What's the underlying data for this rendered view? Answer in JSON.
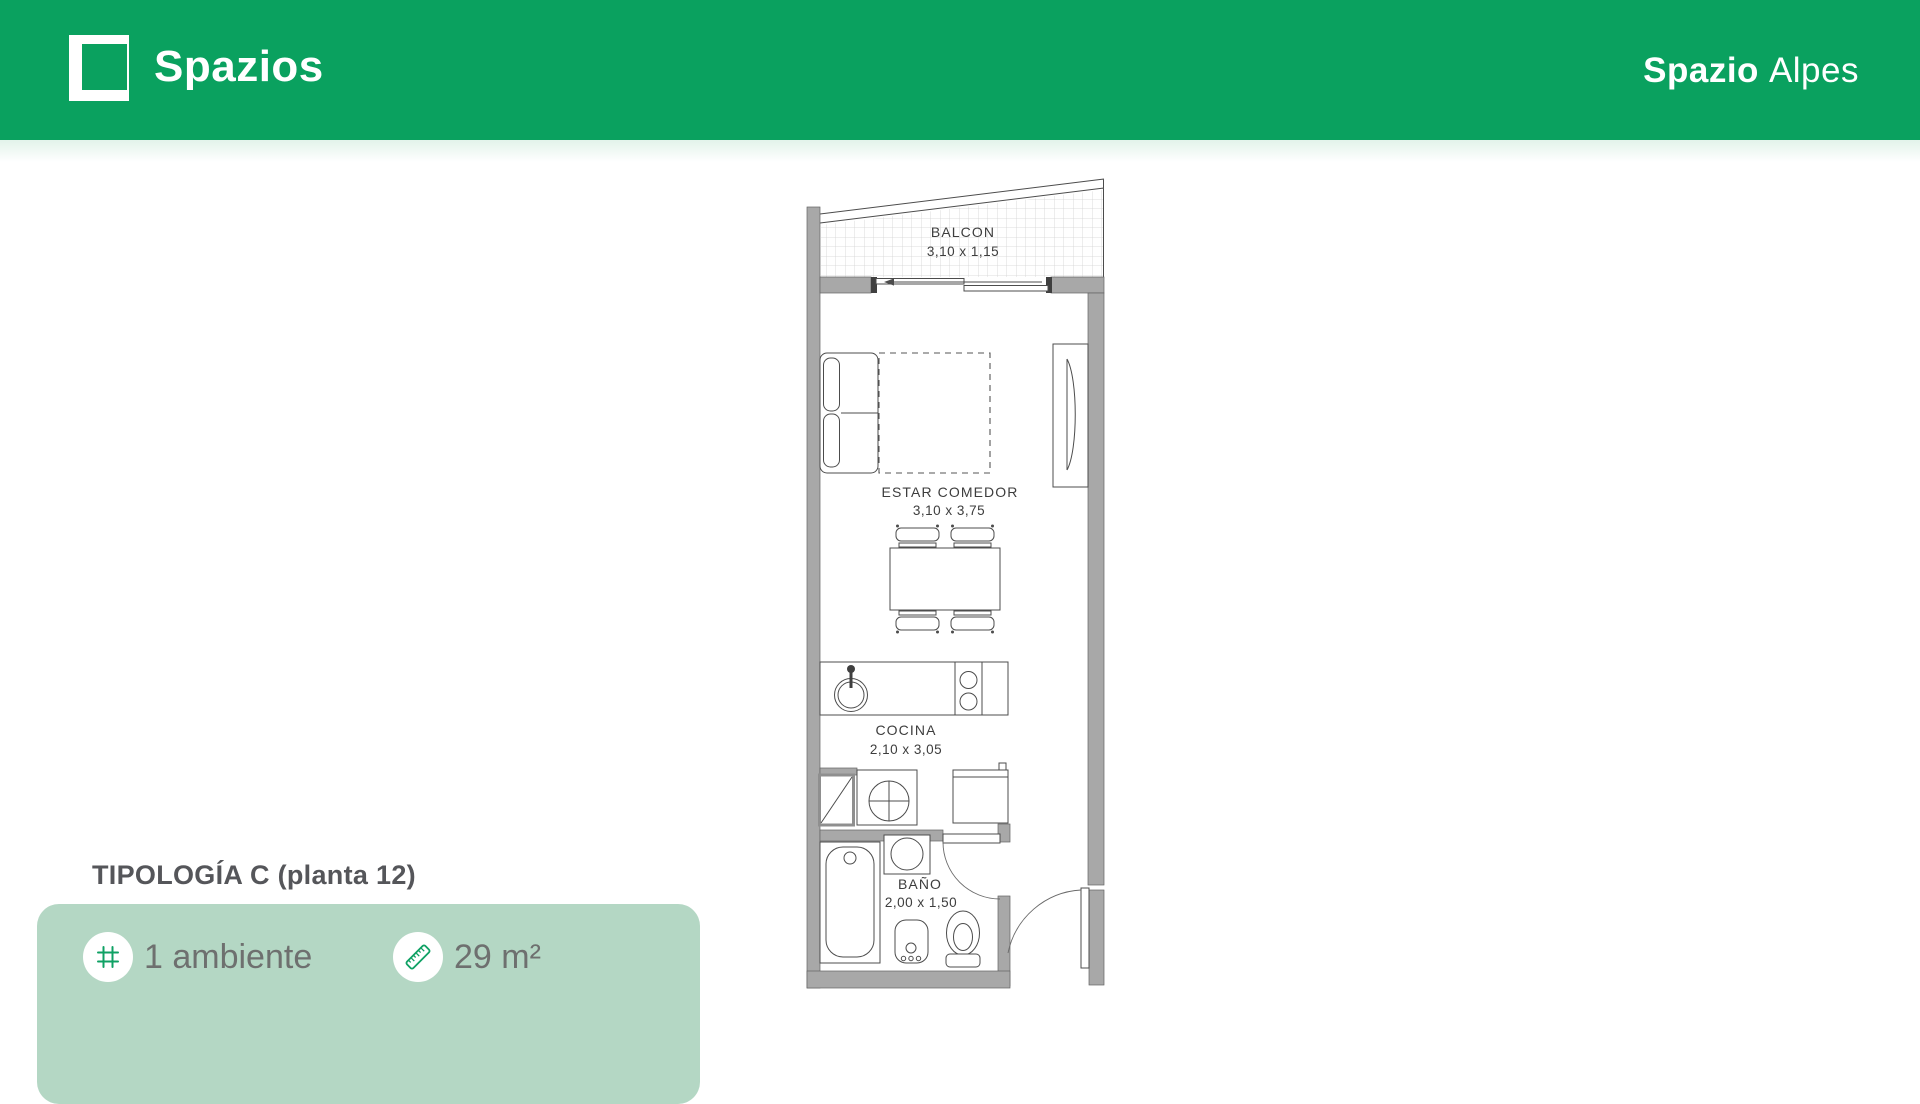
{
  "header": {
    "brand": "Spazios",
    "project": {
      "bold": "Spazio",
      "light": "Alpes"
    }
  },
  "floor_plan": {
    "rooms": [
      {
        "id": "balcon",
        "name": "BALCON",
        "dims": "3,10 x 1,15"
      },
      {
        "id": "estar-comedor",
        "name": "ESTAR COMEDOR",
        "dims": "3,10 x 3,75"
      },
      {
        "id": "cocina",
        "name": "COCINA",
        "dims": "2,10 x 3,05"
      },
      {
        "id": "bano",
        "name": "BAÑO",
        "dims": "2,00 x 1,50"
      }
    ]
  },
  "typology": {
    "title": "TIPOLOGÍA C (planta 12)",
    "features": [
      {
        "icon": "grid-icon",
        "label": "1 ambiente"
      },
      {
        "icon": "ruler-icon",
        "label": "29 m²"
      }
    ]
  },
  "colors": {
    "header_green": "#0AA15F",
    "card_green": "#B4D7C4",
    "icon_green": "#0FA164",
    "wall_gray": "#A8A8A8"
  }
}
